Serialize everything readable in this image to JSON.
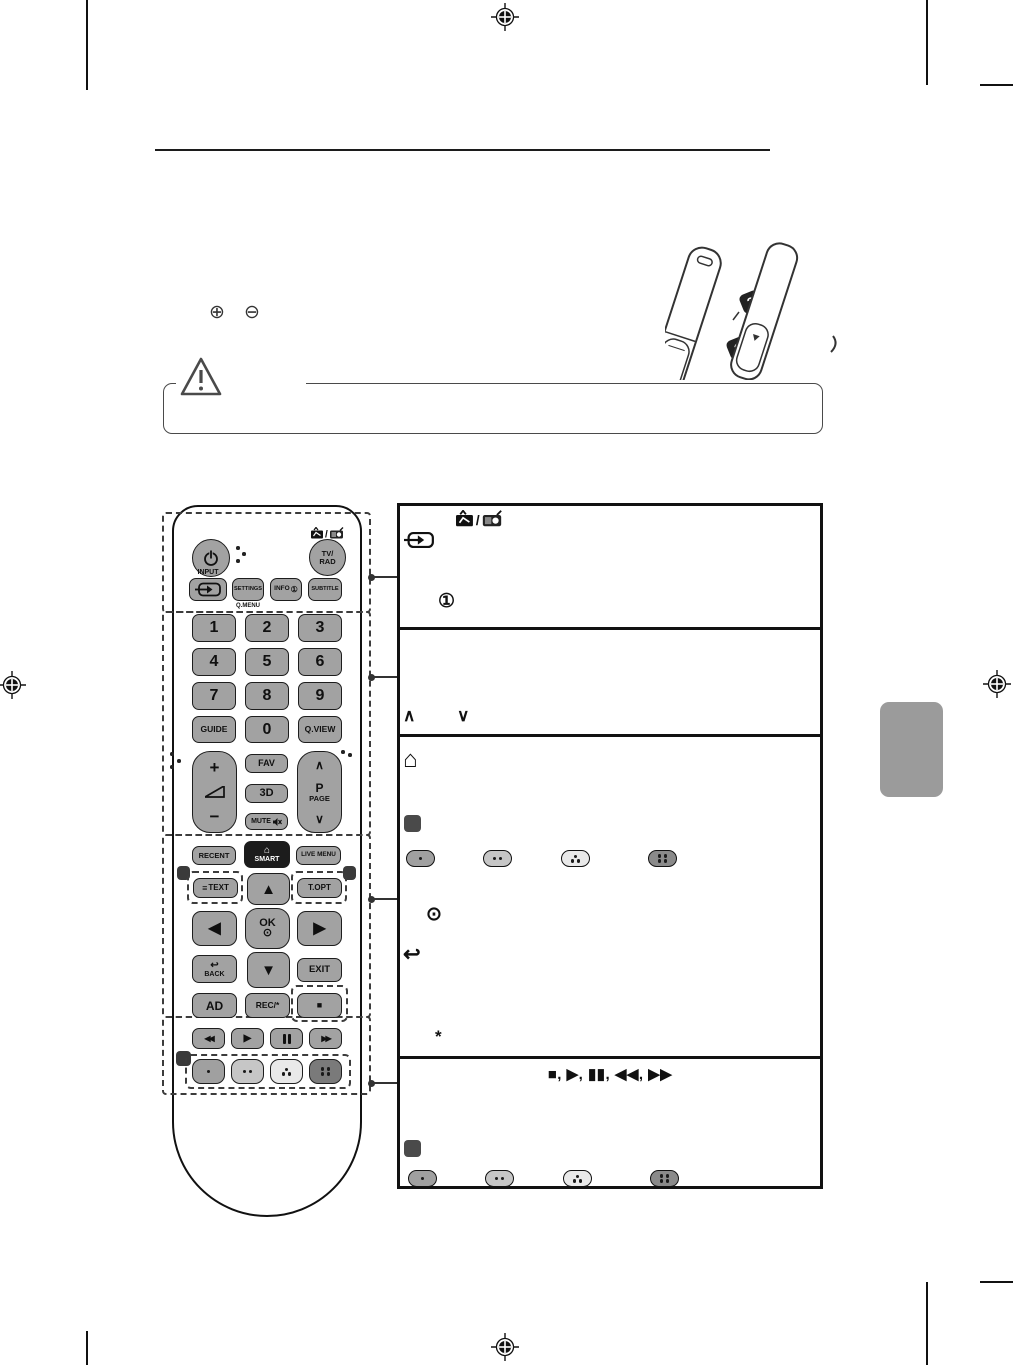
{
  "colors": {
    "button_gray": "#a2a2a2",
    "button_dark": "#1c1c1c",
    "tab_gray": "#9b9b9b",
    "pill_red": "#a0a0a0",
    "pill_green": "#c6c6c6",
    "pill_yellow": "#e9e9e9",
    "pill_blue": "#7a7a7a"
  },
  "symbols": {
    "plus_circle": "⊕",
    "minus_circle": "⊖"
  },
  "battery": {
    "step2": "2",
    "step1": "1"
  },
  "remote": {
    "tv_rad_line1": "TV/",
    "tv_rad_line2": "RAD",
    "input_label": "INPUT",
    "settings": "SETTINGS",
    "qmenu": "Q.MENU",
    "info": "INFO",
    "info_icon": "①",
    "subtitle": "SUBTITLE",
    "digits": [
      "1",
      "2",
      "3",
      "4",
      "5",
      "6",
      "7",
      "8",
      "9"
    ],
    "guide": "GUIDE",
    "zero": "0",
    "qview": "Q.VIEW",
    "vol_plus": "+",
    "vol_minus": "−",
    "fav": "FAV",
    "three_d": "3D",
    "mute": "MUTE",
    "page_up": "∧",
    "page_p": "P",
    "page_label": "PAGE",
    "page_down": "∨",
    "recent": "RECENT",
    "smart_home": "⌂",
    "smart": "SMART",
    "live_menu": "LIVE MENU",
    "text_icon": "≡",
    "text": "TEXT",
    "topt": "T.OPT",
    "up": "▲",
    "left": "◀",
    "right": "▶",
    "down": "▼",
    "ok": "OK",
    "ok_wheel": "⊙",
    "back_icon": "↩",
    "back": "BACK",
    "exit": "EXIT",
    "ad": "AD",
    "rec": "REC/*",
    "stop": "■",
    "rew": "◀◀",
    "play": "▶",
    "ff": "▶▶"
  },
  "panel": {
    "info_icon": "①",
    "chev_up": "∧",
    "chev_down": "∨",
    "home": "⌂",
    "wheel": "⊙",
    "back_arrow": "↩",
    "asterisk": "*",
    "playback_line": "■, ▶, ▮▮, ◀◀, ▶▶"
  }
}
